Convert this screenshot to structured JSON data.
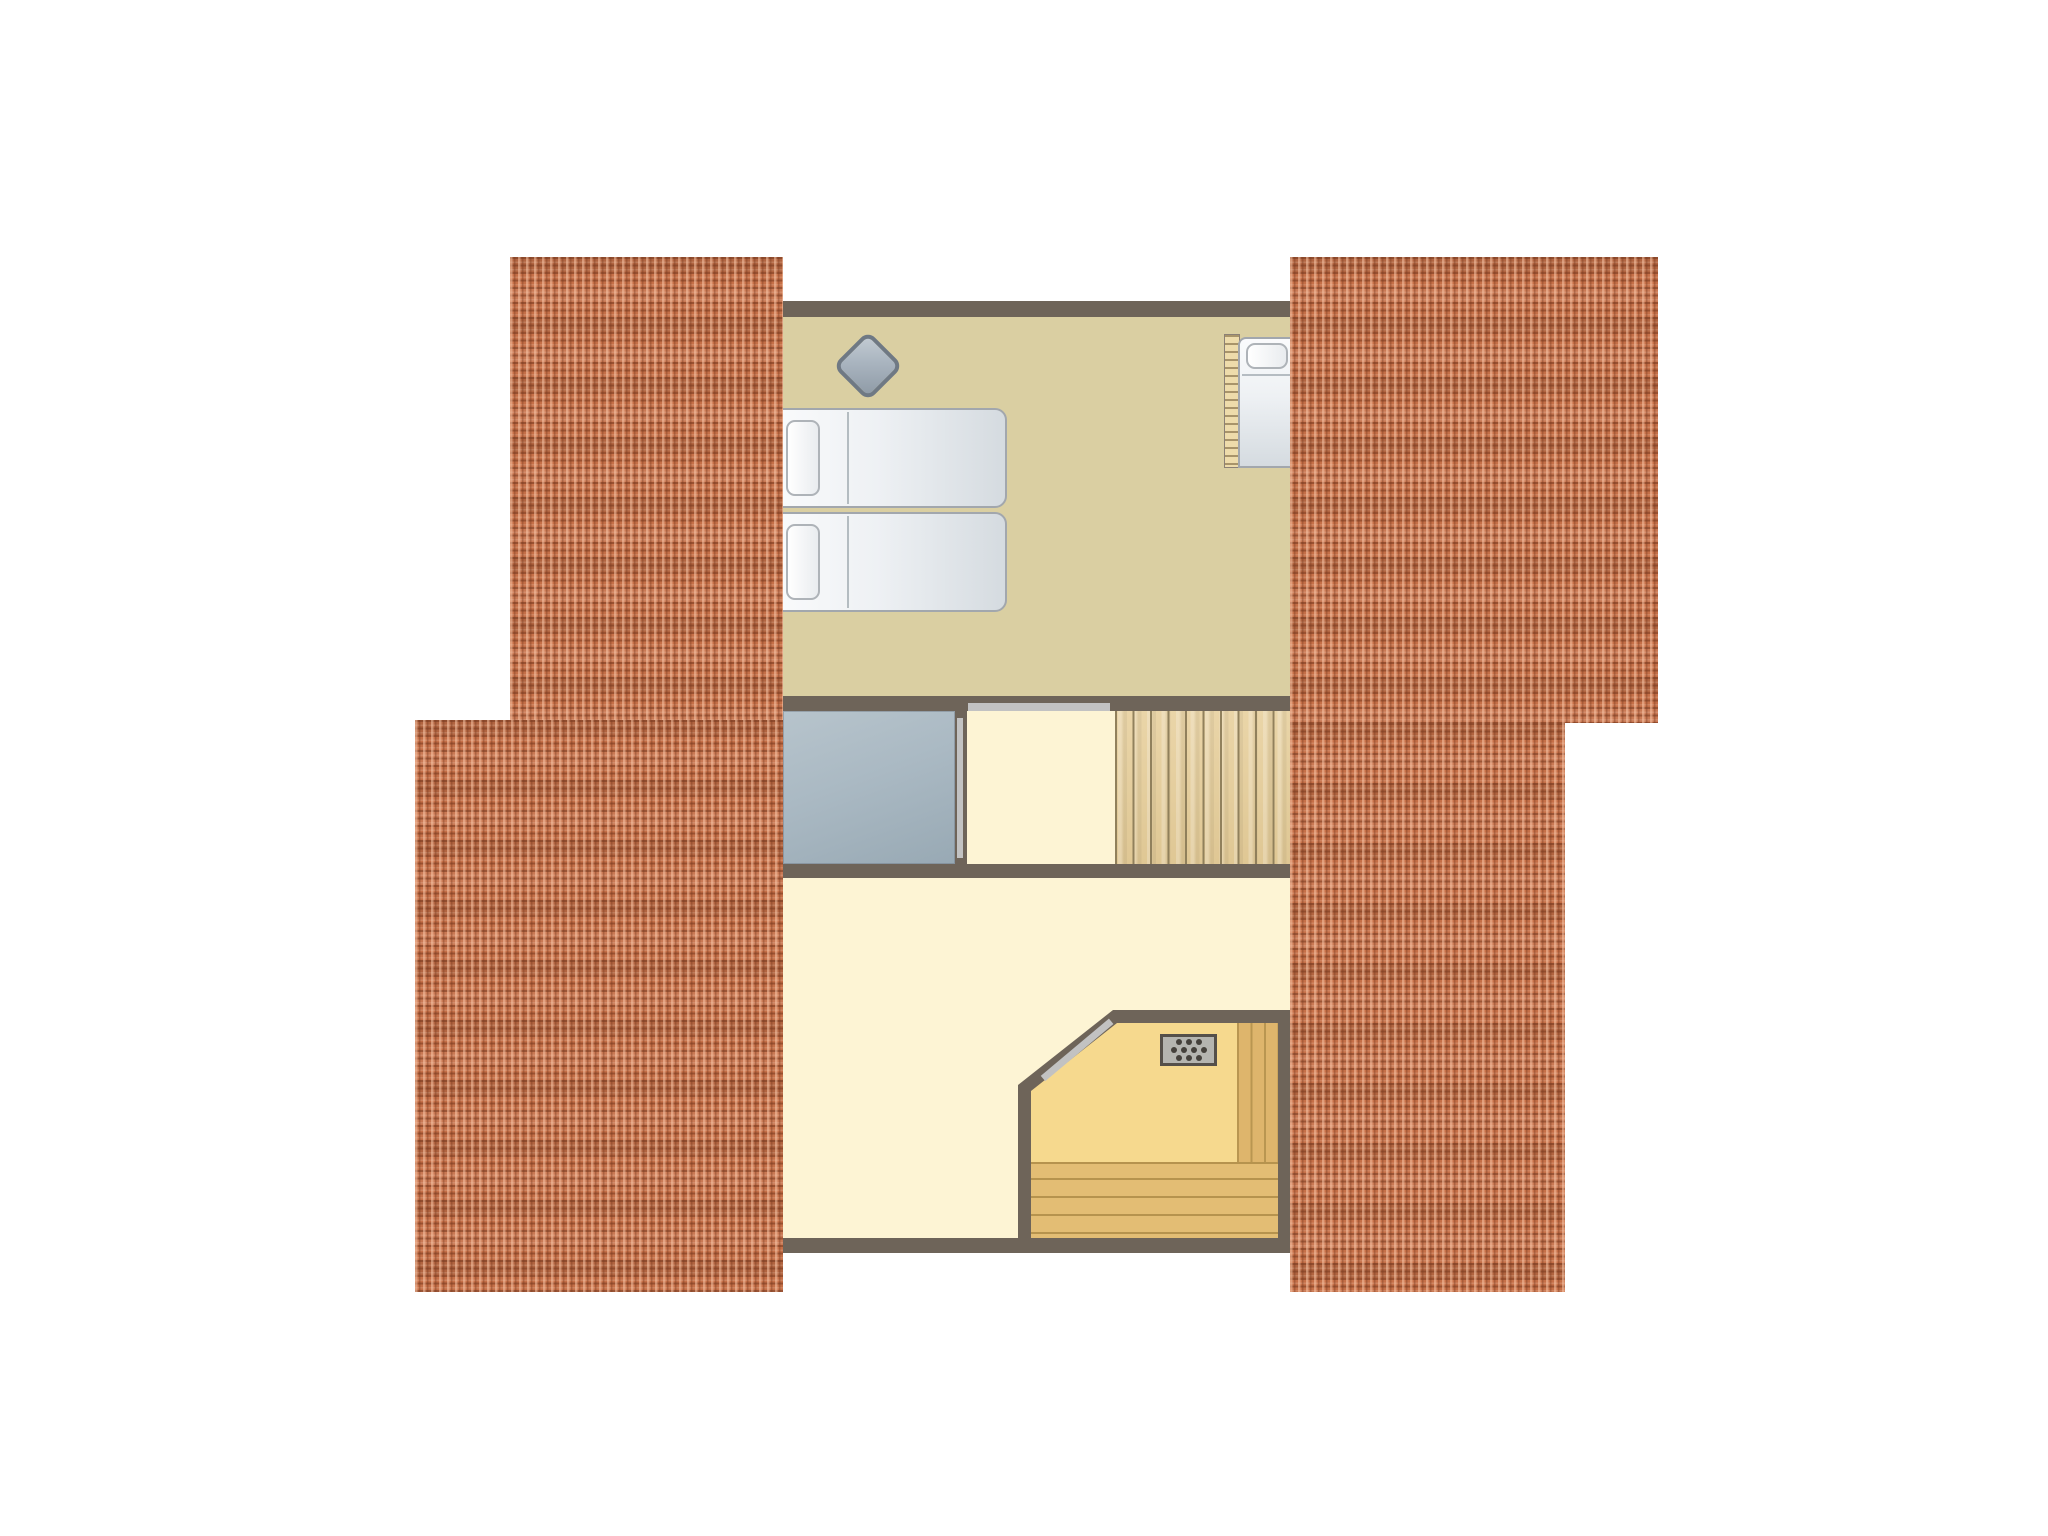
{
  "diagram": {
    "type": "floor-plan",
    "level": "attic",
    "rooms": [
      {
        "name": "bedroom",
        "floor_color": "#dacfa2",
        "contents": [
          "double-bed",
          "bedside-diamond-stool",
          "single-bed",
          "radiator"
        ]
      },
      {
        "name": "landing-hall",
        "floor_color": "#fdf4d4",
        "contents": [
          "door-to-bedroom"
        ]
      },
      {
        "name": "staircase",
        "floor_color": "#e6cfa0",
        "treads": 10
      },
      {
        "name": "storage-void",
        "floor_color": "#aab9c3",
        "contents": [
          "sliding-door"
        ]
      },
      {
        "name": "lower-room",
        "floor_color": "#fdf4d4",
        "contents": [
          "sauna"
        ]
      },
      {
        "name": "sauna",
        "floor_color": "#f6d98e",
        "contents": [
          "sauna-heater",
          "bench",
          "plank-wall",
          "diagonal-door"
        ],
        "bench_planks": 4,
        "heater_dots": 10
      }
    ],
    "furniture": {
      "double_bed": {
        "beds": 2,
        "pillows": 2,
        "fill": "#eef1f4"
      },
      "single_bed": {
        "beds": 1,
        "pillows": 1,
        "fill": "#eef1f4"
      },
      "diamond_stool": {
        "fill": "#a9b4bf"
      },
      "sauna_heater": {
        "dots": 10,
        "fill": "#b5b5b0"
      }
    },
    "roof": {
      "sections": 4,
      "tile_color": "#c56f47",
      "layout": [
        "left-top",
        "left-bottom",
        "right-top",
        "right-bottom"
      ]
    },
    "colors": {
      "background": "#ffffff",
      "wall": "#6e6459",
      "roof-base": "#c56f47",
      "roof-light": "#ef9e74",
      "roof-dark": "#8a4b2e",
      "floor-tan": "#dacfa2",
      "floor-cream": "#fdf4d4",
      "sauna-floor": "#f6d98e",
      "stair-wood": "#e6cfa0",
      "stair-line": "#8c7c58",
      "bench-wood": "#e3bd74",
      "bench-line": "#b6934e",
      "strip-wood": "#ddb46b",
      "storage-fill": "#aab9c3",
      "door-light": "#c2c2c2",
      "bed-fill": "#eef1f4",
      "bed-border": "#a2a7ad",
      "pillow-fill": "#ffffff",
      "diamond-fill": "#a9b4bf",
      "diamond-border": "#6f7984",
      "stove-fill": "#b5b5b0",
      "stove-border": "#55504a",
      "stove-dot": "#45413b",
      "radiator-fill": "#eedcab",
      "radiator-line": "#a8946a"
    }
  }
}
